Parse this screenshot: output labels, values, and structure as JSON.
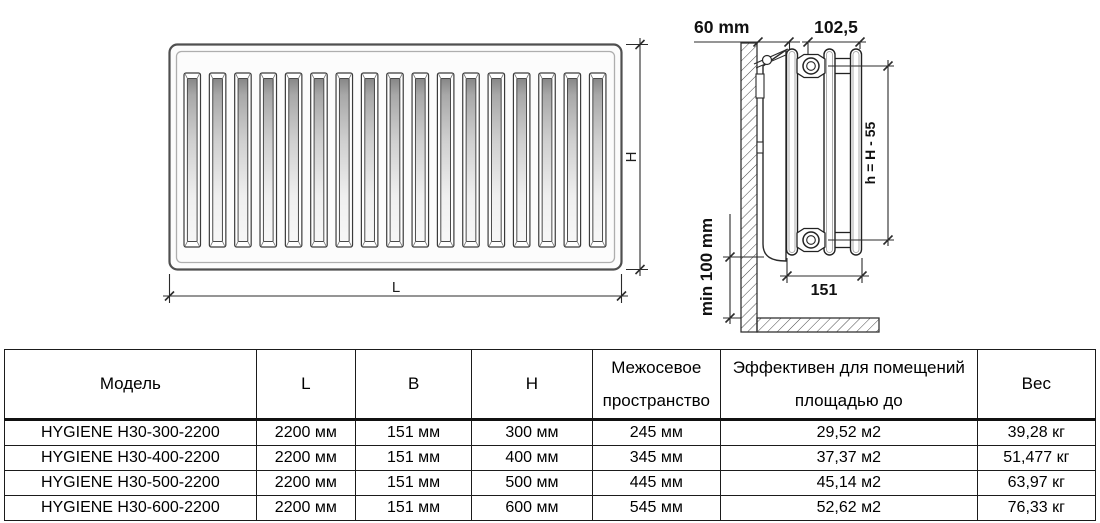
{
  "drawing": {
    "front_view": {
      "slat_count": 17,
      "height_label": "H",
      "length_label": "L"
    },
    "side_view": {
      "wall_offset_label": "60 mm",
      "top_depth_label": "102,5",
      "height_formula_label": "h = H - 55",
      "floor_clearance_label": "min 100 mm",
      "depth_label": "151"
    }
  },
  "table": {
    "columns": [
      [
        "Модель"
      ],
      [
        "L"
      ],
      [
        "B"
      ],
      [
        "H"
      ],
      [
        "Межосевое",
        "пространство"
      ],
      [
        "Эффективен для помещений",
        "площадью до"
      ],
      [
        "Вес"
      ]
    ],
    "rows": [
      [
        "HYGIENE H30-300-2200",
        "2200 мм",
        "151 мм",
        "300 мм",
        "245 мм",
        "29,52 м2",
        "39,28 кг"
      ],
      [
        "HYGIENE H30-400-2200",
        "2200 мм",
        "151 мм",
        "400 мм",
        "345 мм",
        "37,37 м2",
        "51,477 кг"
      ],
      [
        "HYGIENE H30-500-2200",
        "2200 мм",
        "151 мм",
        "500 мм",
        "445 мм",
        "45,14 м2",
        "63,97 кг"
      ],
      [
        "HYGIENE H30-600-2200",
        "2200 мм",
        "151 мм",
        "600 мм",
        "545 мм",
        "52,62 м2",
        "76,33 кг"
      ]
    ]
  }
}
